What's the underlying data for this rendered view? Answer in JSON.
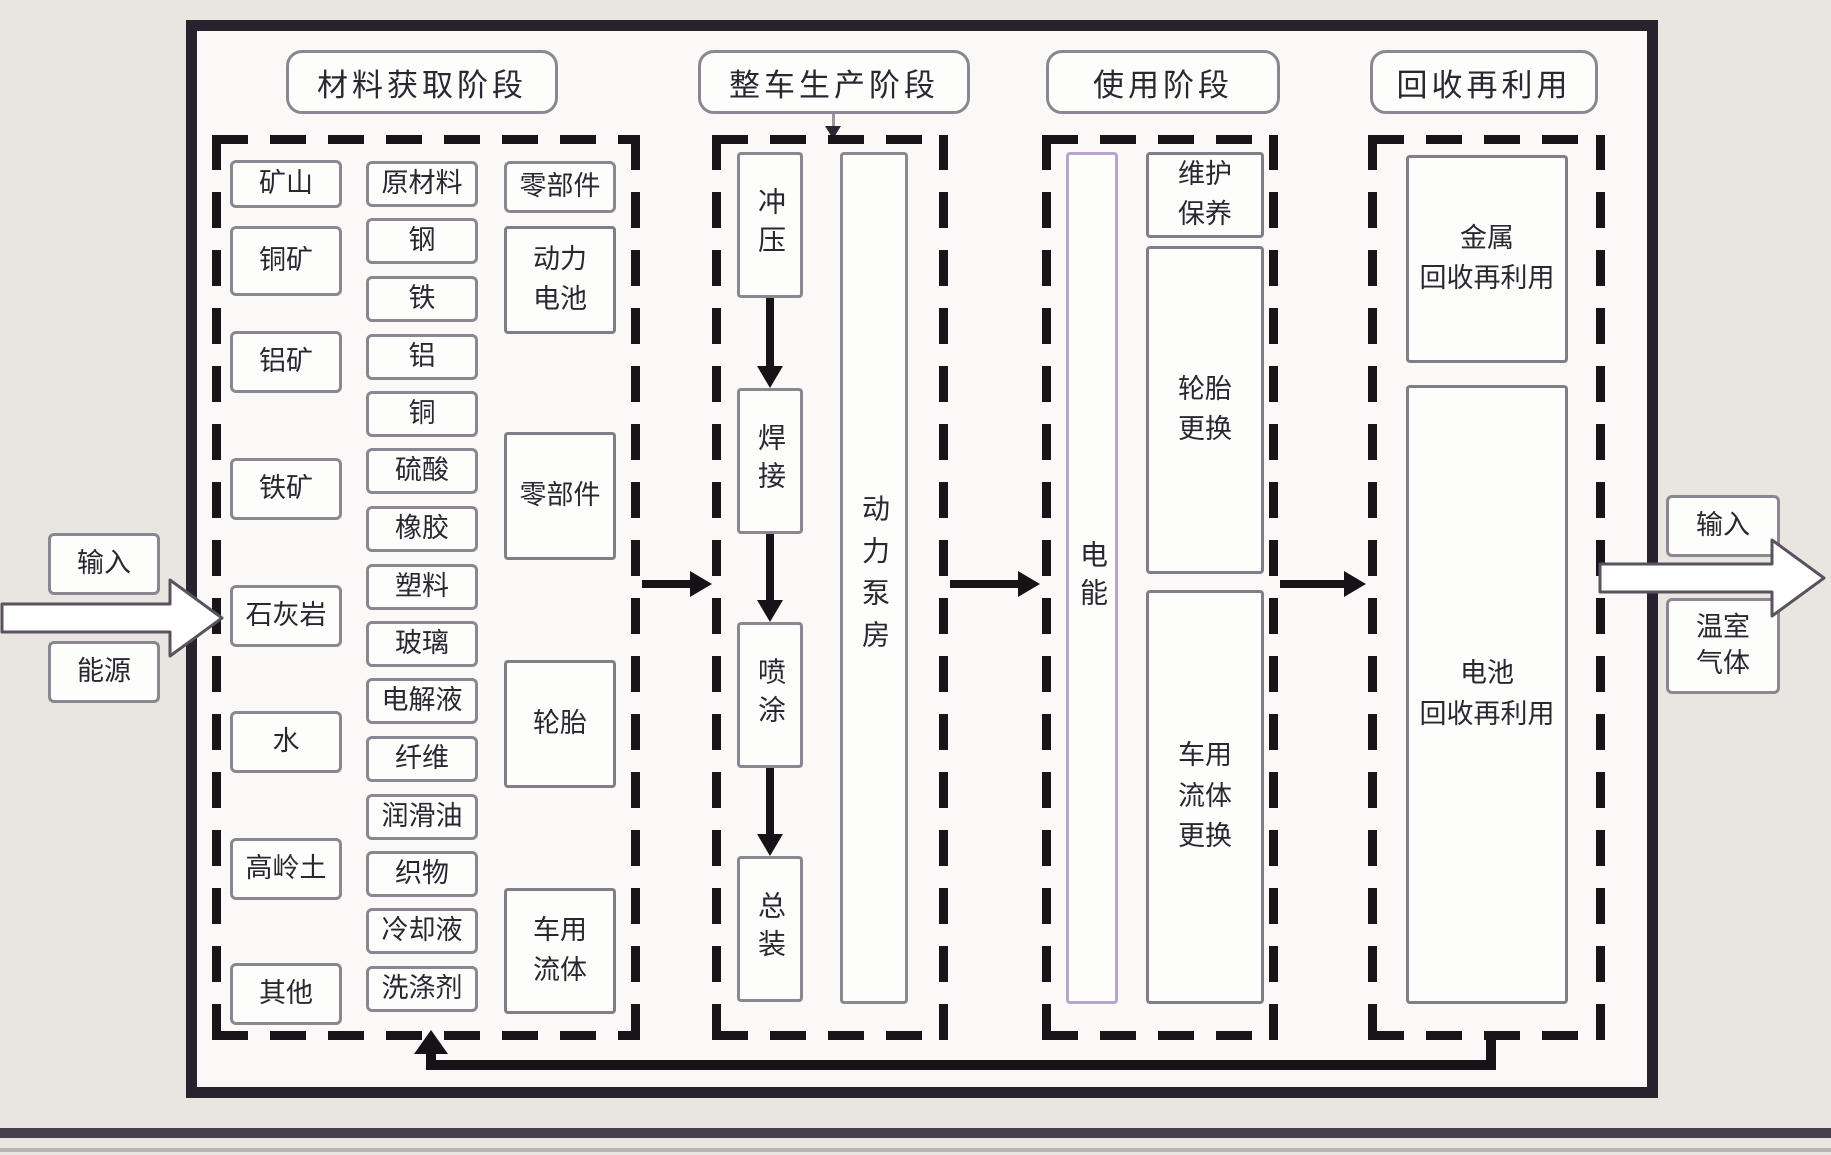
{
  "diagram": {
    "stage_titles": [
      "材料获取阶段",
      "整车生产阶段",
      "使用阶段",
      "回收再利用"
    ],
    "material_stage": {
      "sources": [
        "矿山",
        "铜矿",
        "铝矿",
        "铁矿",
        "石灰岩",
        "水",
        "高岭土",
        "其他"
      ],
      "materials": [
        "原材料",
        "钢",
        "铁",
        "铝",
        "铜",
        "硫酸",
        "橡胶",
        "塑料",
        "玻璃",
        "电解液",
        "纤维",
        "润滑油",
        "织物",
        "冷却液",
        "洗涤剂"
      ],
      "components": [
        "零部件",
        "动力\n电池",
        "零部件",
        "轮胎",
        "车用\n流体"
      ]
    },
    "production_stage": {
      "processes": [
        "冲压",
        "焊接",
        "喷涂",
        "总装"
      ],
      "power_pump_room": "动力泵房"
    },
    "use_stage": {
      "electric_energy": "电能",
      "activities": [
        "维护\n保养",
        "轮胎\n更换",
        "车用\n流体\n更换"
      ]
    },
    "recycling_stage": {
      "items": [
        "金属\n回收再利用",
        "电池\n回收再利用"
      ]
    },
    "inputs": {
      "label": "输入",
      "energy": "能源"
    },
    "outputs": {
      "label": "输入",
      "greenhouse_gas": "温室\n气体"
    },
    "colors": {
      "outer_border": "#27222e",
      "dashed_border": "#17141a",
      "box_border": "#8b8792",
      "energy_box_border": "#b7a5cd",
      "background": "#e9e6e1",
      "text": "#2a2730"
    }
  }
}
